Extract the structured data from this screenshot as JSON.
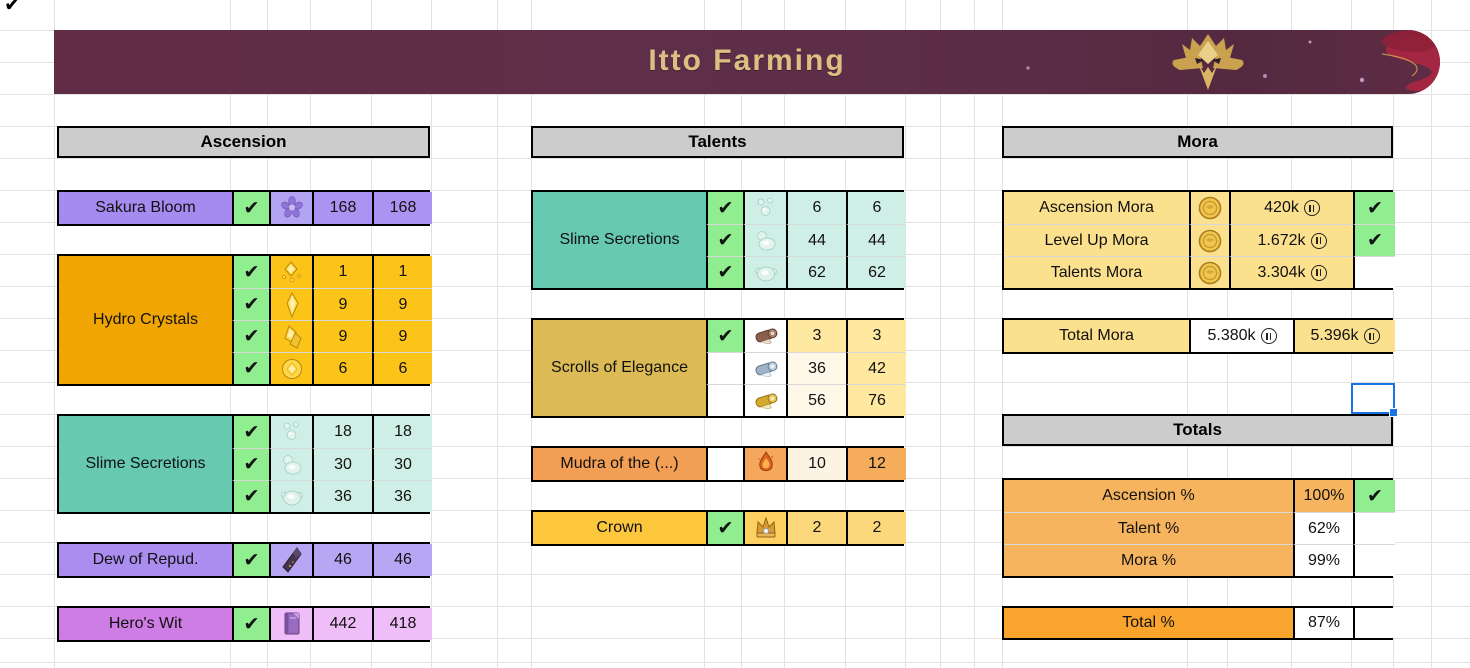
{
  "banner": {
    "title": "Itto Farming"
  },
  "glyphs": {
    "check": "✔"
  },
  "colors": {
    "banner_left": "#612c45",
    "banner_right": "#54293f",
    "title_gold": "#dcbf82",
    "header_bg": "#cccccc",
    "gridline": "#e2e2e2",
    "check_green": "#90ee90",
    "selection_blue": "#1b73e8"
  },
  "ascension": {
    "header": "Ascension",
    "groups": [
      {
        "name": "Sakura Bloom",
        "label_bg": "#a58bef",
        "cell_bg": "#ab94f1",
        "icon_bg": "#b2a4f3",
        "rows": [
          {
            "checked": true,
            "icon": "sakura-bloom-icon",
            "have": "168",
            "need": "168"
          }
        ]
      },
      {
        "name": "Hydro Crystals",
        "label_bg": "#f0a502",
        "cell_bg": "#fcc419",
        "icon_bg": "#fcc419",
        "rows": [
          {
            "checked": true,
            "icon": "geo-sliver-icon",
            "have": "1",
            "need": "1"
          },
          {
            "checked": true,
            "icon": "geo-fragment-icon",
            "have": "9",
            "need": "9"
          },
          {
            "checked": true,
            "icon": "geo-chunk-icon",
            "have": "9",
            "need": "9"
          },
          {
            "checked": true,
            "icon": "geo-gemstone-icon",
            "have": "6",
            "need": "6"
          }
        ]
      },
      {
        "name": "Slime Secretions",
        "label_bg": "#66c9b0",
        "cell_bg": "#cfeee6",
        "icon_bg": "#cfeee6",
        "rows": [
          {
            "checked": true,
            "icon": "slime-condensate-icon",
            "have": "18",
            "need": "18"
          },
          {
            "checked": true,
            "icon": "slime-secretions-icon",
            "have": "30",
            "need": "30"
          },
          {
            "checked": true,
            "icon": "slime-concentrate-icon",
            "have": "36",
            "need": "36"
          }
        ]
      },
      {
        "name": "Dew of Repud.",
        "label_bg": "#ab8def",
        "cell_bg": "#b7a6f3",
        "icon_bg": "#b7a6f3",
        "rows": [
          {
            "checked": true,
            "icon": "dew-icon",
            "have": "46",
            "need": "46"
          }
        ]
      },
      {
        "name": "Hero's Wit",
        "label_bg": "#ce7de4",
        "cell_bg": "#efbdf8",
        "icon_bg": "#efbdf8",
        "rows": [
          {
            "checked": true,
            "icon": "heros-wit-icon",
            "have": "442",
            "need": "418"
          }
        ]
      }
    ]
  },
  "talents": {
    "header": "Talents",
    "groups": [
      {
        "name": "Slime Secretions",
        "label_bg": "#66c9b0",
        "cell_bg": "#cfeee6",
        "icon_bg": "#cfeee6",
        "rows": [
          {
            "checked": true,
            "icon": "slime-condensate-icon",
            "have": "6",
            "need": "6"
          },
          {
            "checked": true,
            "icon": "slime-secretions-icon",
            "have": "44",
            "need": "44"
          },
          {
            "checked": true,
            "icon": "slime-concentrate-icon",
            "have": "62",
            "need": "62"
          }
        ]
      },
      {
        "name": "Scrolls of Elegance",
        "label_bg": "#dcba55",
        "cell_bg": "#ffe8a0",
        "icon_bg": "#ffffff",
        "rows": [
          {
            "checked": true,
            "icon": "scroll-teachings-icon",
            "have": "3",
            "need": "3"
          },
          {
            "checked": false,
            "icon": "scroll-guide-icon",
            "have": "36",
            "need": "42",
            "have_bg": "#fdf8e8"
          },
          {
            "checked": false,
            "icon": "scroll-philosophies-icon",
            "have": "56",
            "need": "76",
            "have_bg": "#fdf8e8"
          }
        ]
      },
      {
        "name": "Mudra of the (...)",
        "label_bg": "#f29e54",
        "cell_bg": "#f5ad5b",
        "icon_bg": "#f5a85d",
        "rows": [
          {
            "checked": false,
            "icon": "mudra-icon",
            "have": "10",
            "need": "12",
            "have_bg": "#fdf3e2"
          }
        ]
      },
      {
        "name": "Crown",
        "label_bg": "#fdc73d",
        "cell_bg": "#fcd87d",
        "icon_bg": "#fdd161",
        "rows": [
          {
            "checked": true,
            "icon": "crown-icon",
            "have": "2",
            "need": "2"
          }
        ]
      }
    ]
  },
  "mora": {
    "header": "Mora",
    "row_bg": "#fbe08e",
    "rows": [
      {
        "label": "Ascension Mora",
        "icon": "coin-icon",
        "value": "420k",
        "checked": true
      },
      {
        "label": "Level Up Mora",
        "icon": "coin-icon",
        "value": "1.672k",
        "checked": true
      },
      {
        "label": "Talents Mora",
        "icon": "coin-icon",
        "value": "3.304k",
        "checked": false
      }
    ],
    "total": {
      "label": "Total Mora",
      "have": "5.380k",
      "need": "5.396k",
      "label_bg": "#fbe08e",
      "have_bg": "#ffffff",
      "need_bg": "#fbe08e"
    }
  },
  "totals": {
    "header": "Totals",
    "row_bg": "#f7b45e",
    "rows": [
      {
        "label": "Ascension %",
        "value": "100%",
        "checked": true,
        "value_bg": "#f7b45e"
      },
      {
        "label": "Talent %",
        "value": "62%",
        "checked": false,
        "value_bg": "#ffffff"
      },
      {
        "label": "Mora %",
        "value": "99%",
        "checked": false,
        "value_bg": "#ffffff"
      }
    ],
    "total": {
      "label": "Total %",
      "value": "87%",
      "label_bg": "#f9a42c",
      "value_bg": "#ffffff"
    }
  }
}
